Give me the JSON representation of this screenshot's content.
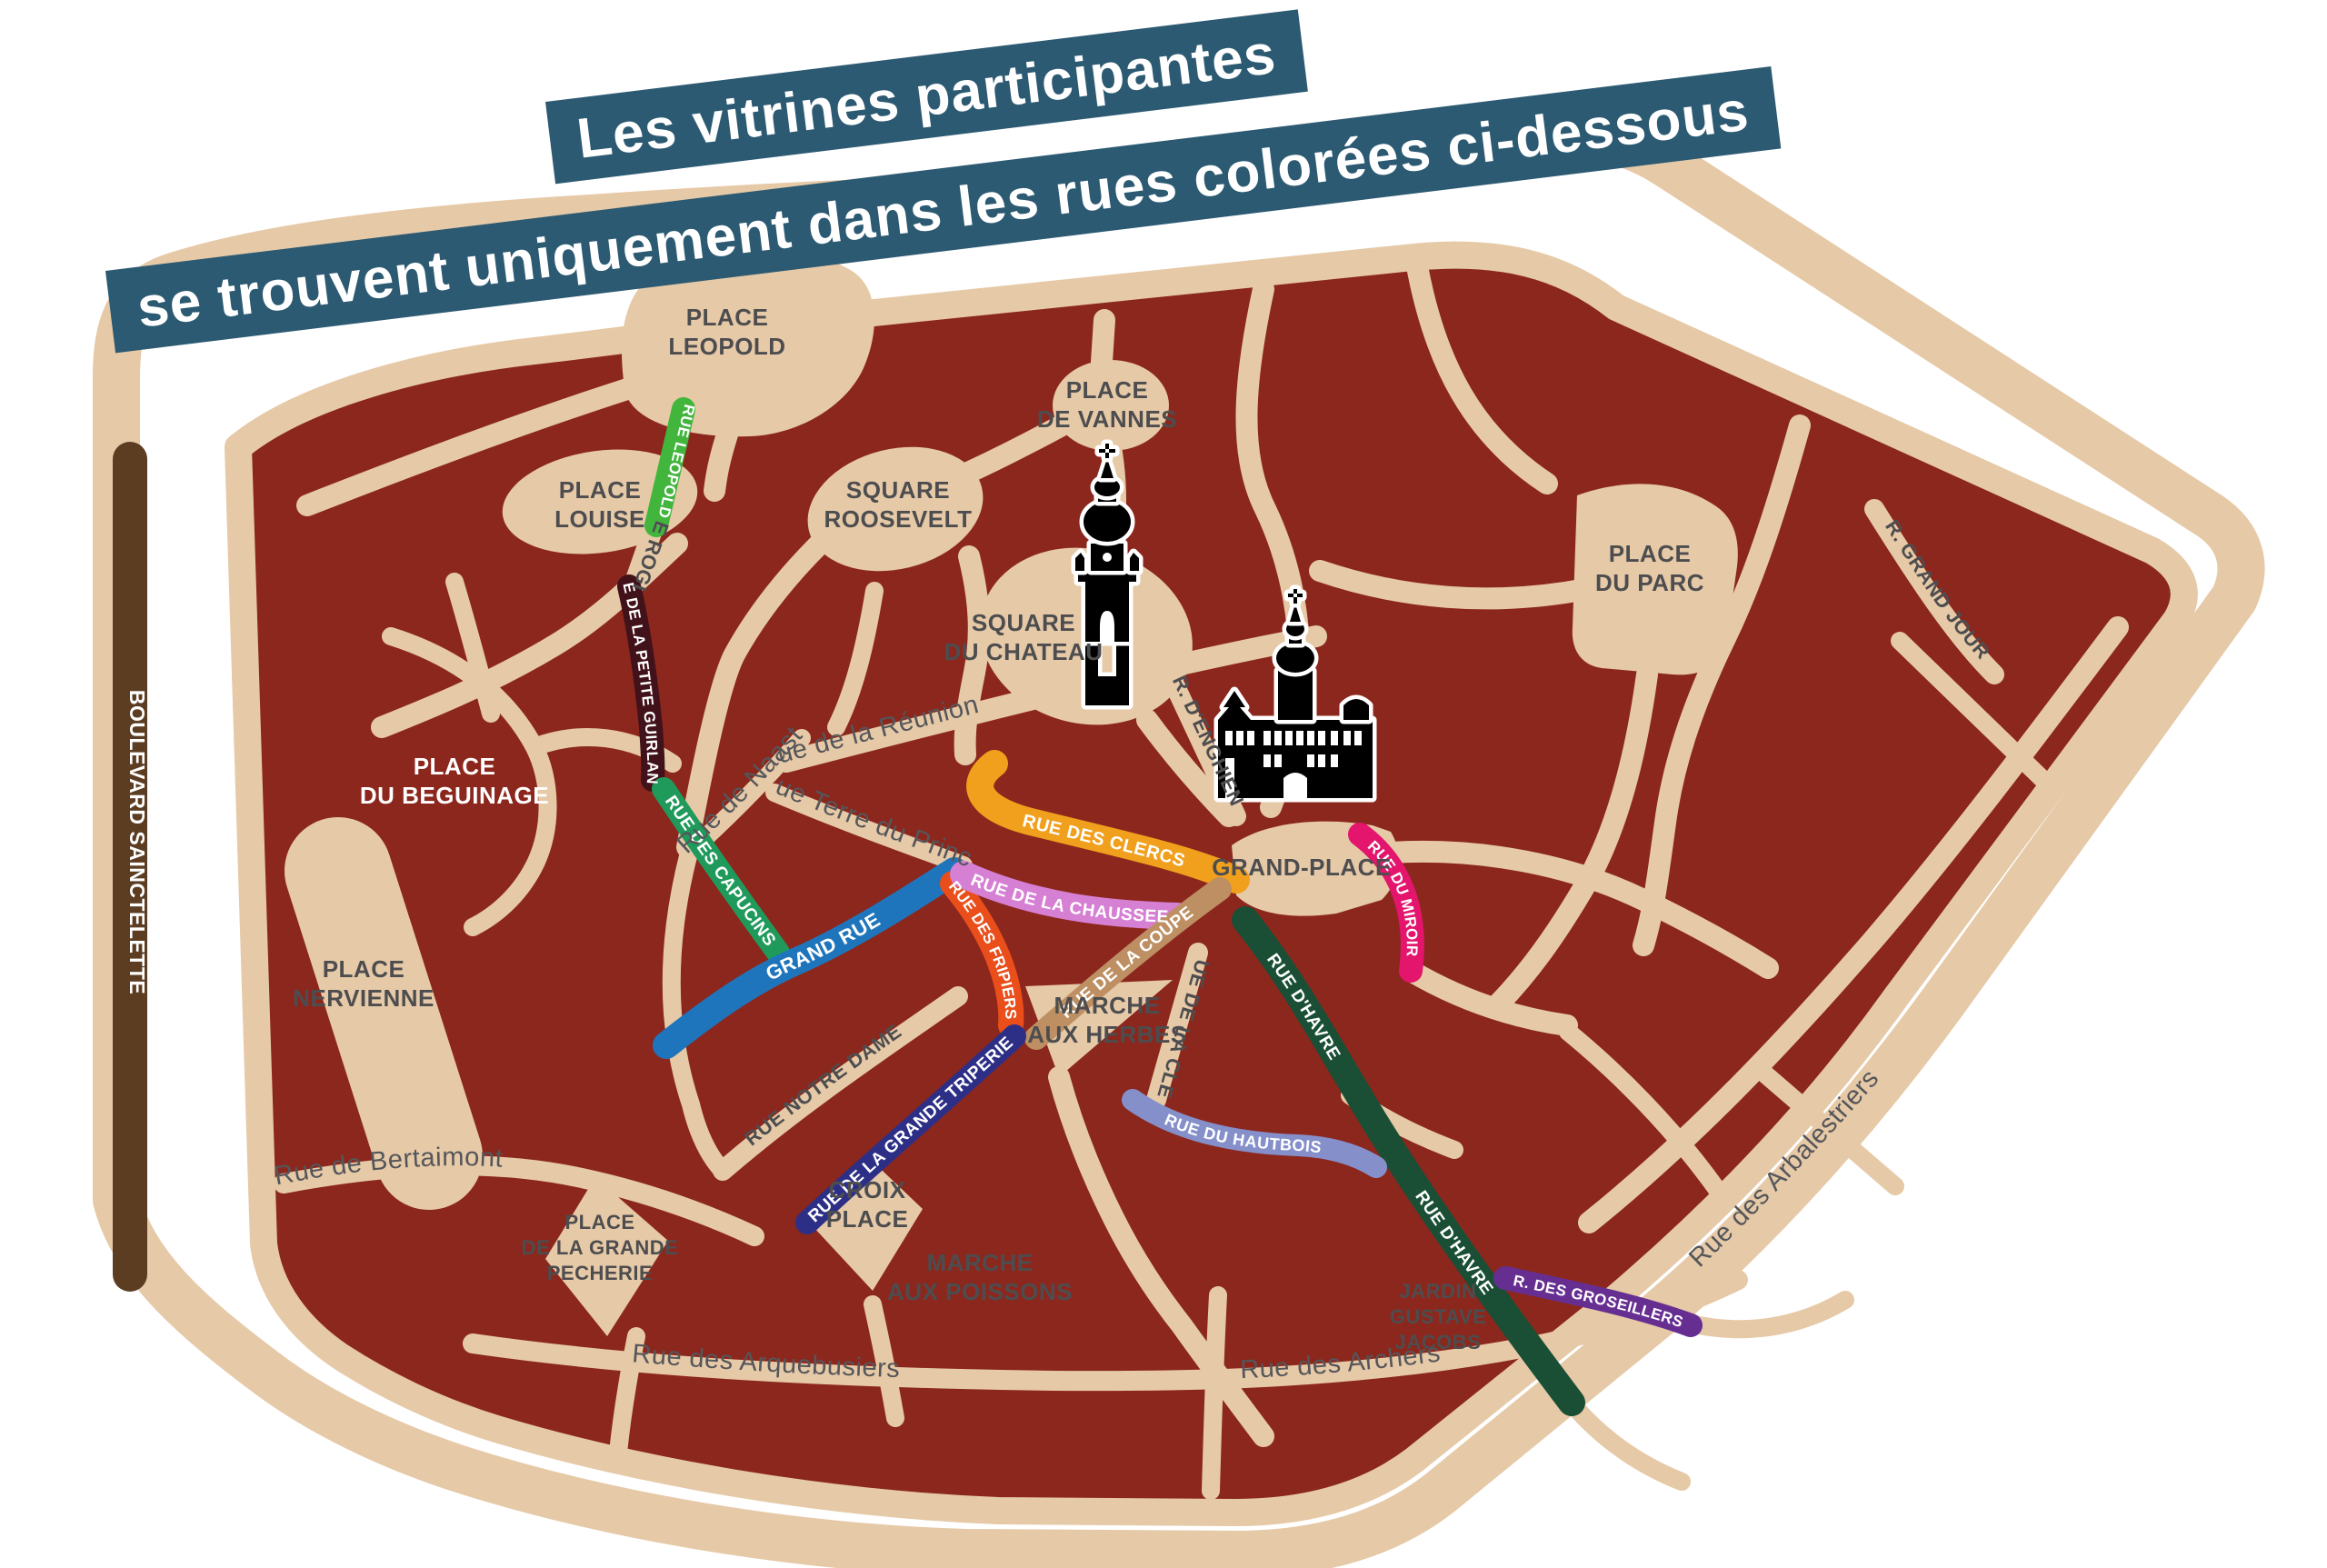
{
  "title": {
    "line1": "Les vitrines participantes",
    "line2": "se trouvent uniquement dans les rues colorées ci-dessous",
    "bg_color": "#2C5A72",
    "text_color": "#FFFFFF"
  },
  "palette": {
    "land": "#8B271D",
    "road": "#E6C9A7",
    "place_label_color": "#4D4D4F",
    "street_label_color": "#55565A",
    "white": "#FFFFFF"
  },
  "boulevard": {
    "name": "BOULEVARD SAINCTELETTE",
    "color": "#5C3D22"
  },
  "colored_streets": [
    {
      "id": "rue-leopold-ii",
      "name": "RUE LEOPOLD II",
      "color": "#42B53D"
    },
    {
      "id": "rue-de-la-petite-guirlande",
      "name": "RUE DE LA PETITE GUIRLANDE",
      "color": "#42121A"
    },
    {
      "id": "rue-des-capucins",
      "name": "RUE DES CAPUCINS",
      "color": "#209A5B"
    },
    {
      "id": "grand-rue",
      "name": "GRAND RUE",
      "color": "#1F75BC"
    },
    {
      "id": "rue-des-fripiers",
      "name": "RUE DES FRIPIERS",
      "color": "#E94E1B"
    },
    {
      "id": "rue-de-la-chaussee",
      "name": "RUE DE LA CHAUSSEE",
      "color": "#D680D4"
    },
    {
      "id": "rue-des-clercs",
      "name": "RUE DES CLERCS",
      "color": "#F0A01C"
    },
    {
      "id": "rue-de-la-coupe",
      "name": "RUE DE LA COUPE",
      "color": "#BD8F63"
    },
    {
      "id": "rue-du-miroir",
      "name": "RUE DU MIROIR",
      "color": "#E3156D"
    },
    {
      "id": "rue-d-havre",
      "name": "RUE D'HAVRE",
      "color": "#1A4F35"
    },
    {
      "id": "rue-du-hautbois",
      "name": "RUE DU HAUTBOIS",
      "color": "#8590CB"
    },
    {
      "id": "r-des-groseillers",
      "name": "R. DES GROSEILLERS",
      "color": "#672E92"
    },
    {
      "id": "rue-de-la-grande-triperie",
      "name": "RUE DE LA GRANDE TRIPERIE",
      "color": "#2D2F87"
    }
  ],
  "places": {
    "leopold": {
      "lines": [
        "PLACE",
        "LEOPOLD"
      ]
    },
    "louise": {
      "lines": [
        "PLACE",
        "LOUISE"
      ]
    },
    "roosevelt": {
      "lines": [
        "SQUARE",
        "ROOSEVELT"
      ]
    },
    "vannes": {
      "lines": [
        "PLACE",
        "DE VANNES"
      ]
    },
    "chateau": {
      "lines": [
        "SQUARE",
        "DU CHATEAU"
      ]
    },
    "parc": {
      "lines": [
        "PLACE",
        "DU PARC"
      ]
    },
    "beguinage": {
      "lines": [
        "PLACE",
        "DU BEGUINAGE"
      ]
    },
    "nervienne": {
      "lines": [
        "PLACE",
        "NERVIENNE"
      ]
    },
    "grand_place": {
      "lines": [
        "GRAND-PLACE"
      ]
    },
    "herbes": {
      "lines": [
        "MARCHE",
        "AUX HERBES"
      ]
    },
    "croix": {
      "lines": [
        "CROIX",
        "PLACE"
      ]
    },
    "pecherie": {
      "lines": [
        "PLACE",
        "DE LA GRANDE",
        "PECHERIE"
      ]
    },
    "poissons": {
      "lines": [
        "MARCHE",
        "AUX POISSONS"
      ]
    },
    "jardin": {
      "lines": [
        "JARDIN",
        "GUSTAVE",
        "JACOBS"
      ]
    }
  },
  "plain_streets": {
    "rogier": "RUE ROGIER",
    "reunion": "Rue de la Réunion",
    "naast": "Rue de Naast",
    "terre_du_prince": "Rue Terre du Prince",
    "enghien": "R. D'ENGHIEN",
    "clef": "RUE DE LA CLEF",
    "notre_dame": "RUE NOTRE DAME",
    "bertaimont": "Rue de Bertaimont",
    "arquebusiers": "Rue des Arquebusiers",
    "archers": "Rue des Archers",
    "arbalestriers": "Rue des Arbalestriers",
    "grand_jour": "R. GRAND JOUR"
  },
  "landmarks": {
    "belfry_icon": "belfry-tower",
    "city_hall_icon": "city-hall"
  }
}
